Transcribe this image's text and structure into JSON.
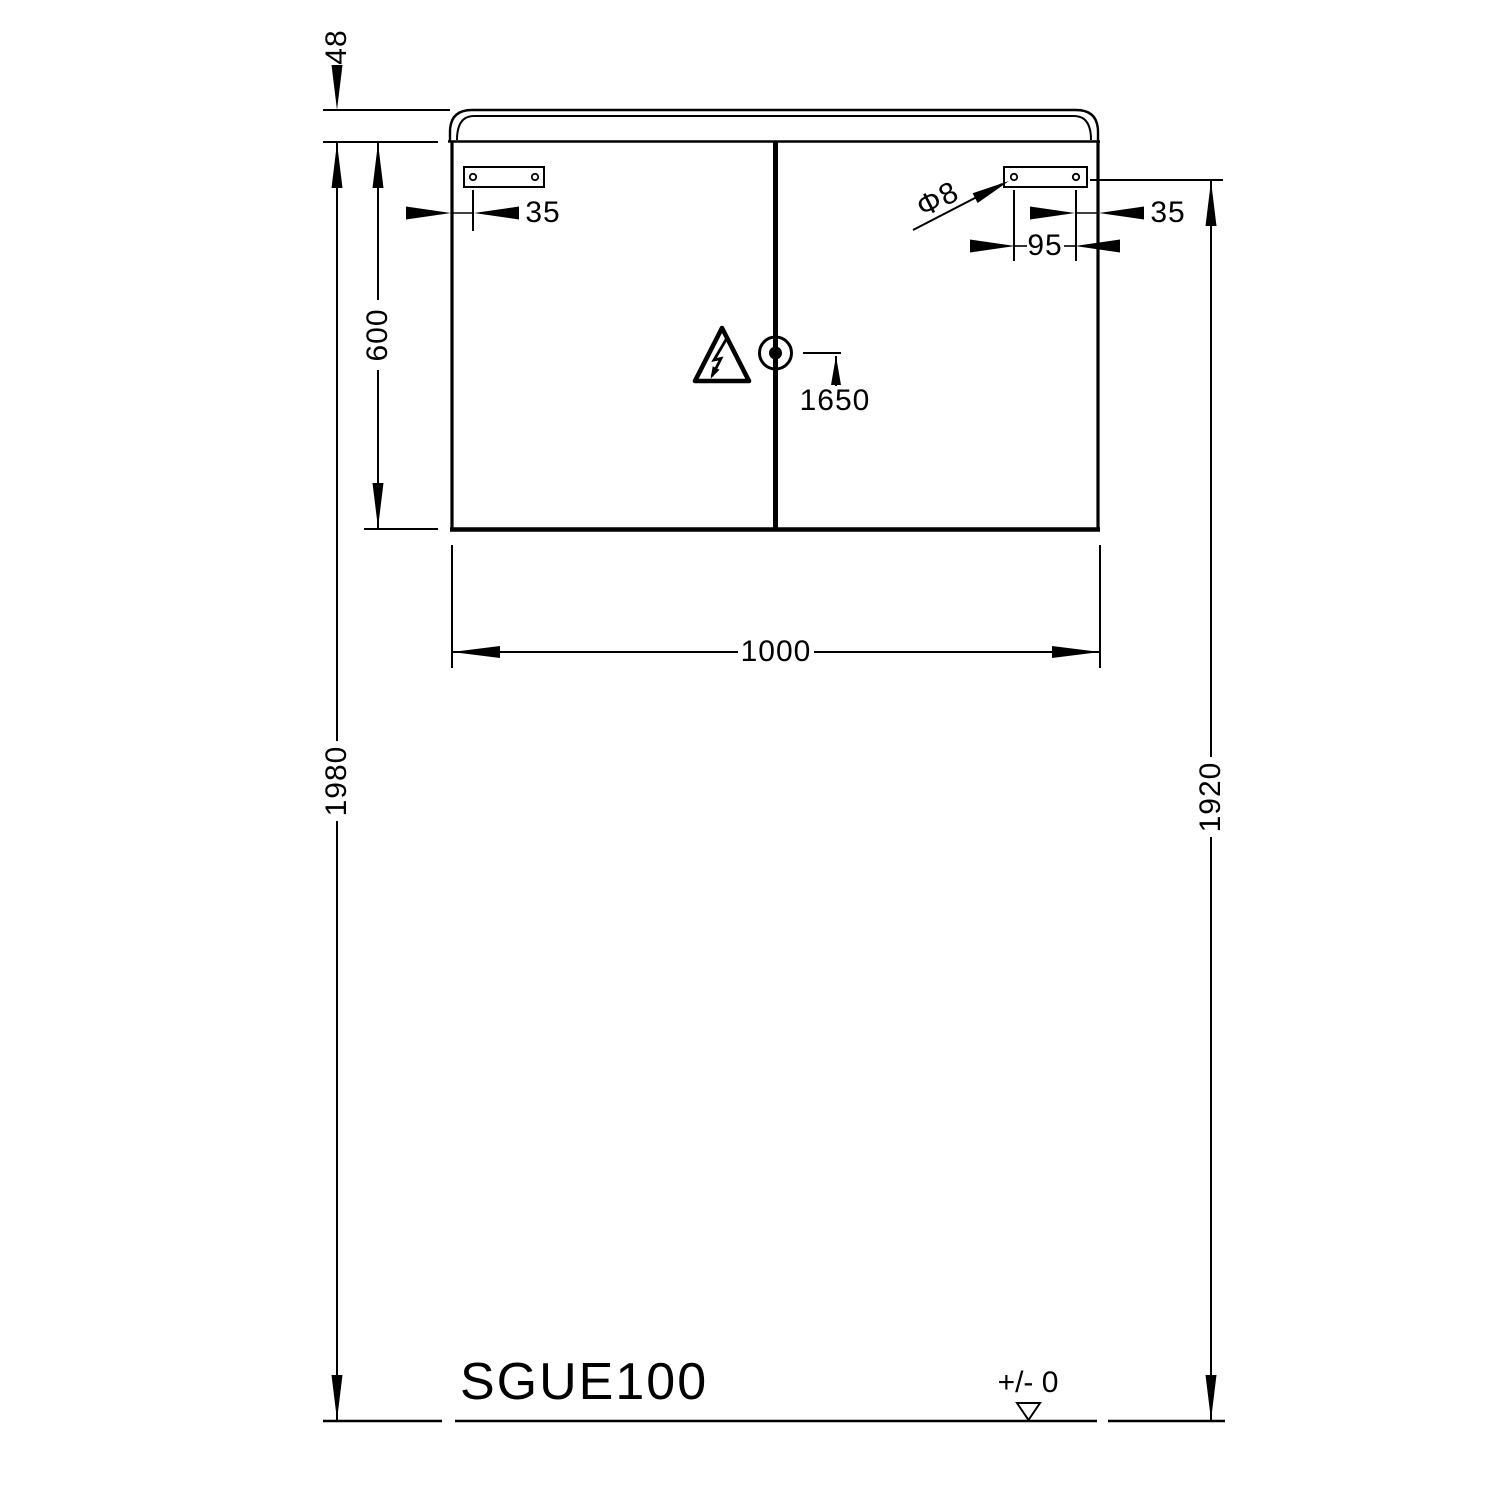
{
  "drawing": {
    "model_label": "SGUE100",
    "datum_label": "+/- 0",
    "dimensions": {
      "lid_height": "48",
      "door_height": "600",
      "overall_height_left": "1980",
      "overall_height_right": "1920",
      "width": "1000",
      "lock_height": "1650",
      "hinge_edge_offset_left": "35",
      "hinge_edge_offset_right": "35",
      "hinge_hole_spacing": "95",
      "hole_diameter": "Φ8"
    }
  }
}
